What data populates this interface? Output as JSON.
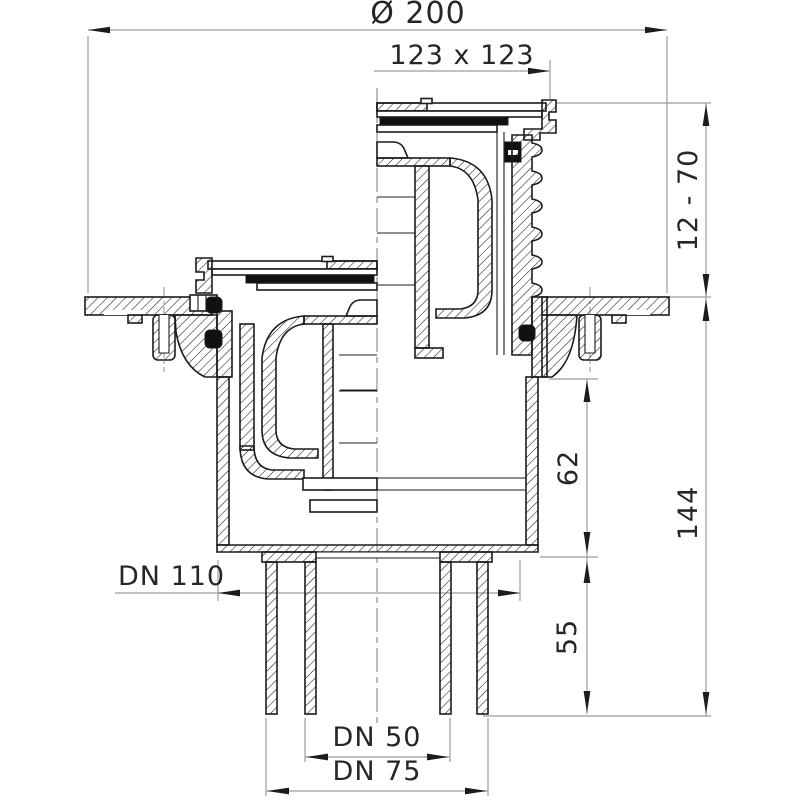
{
  "drawing": {
    "kind": "floor-drain-cross-section",
    "dimensions": {
      "flange_diameter": "Ø 200",
      "grate_size": "123 x 123",
      "height_adjustment": "12 - 70",
      "flange_to_body_bottom": "62",
      "total_height": "144",
      "spigot_length": "55",
      "body_socket": "DN 110",
      "outlet_inner": "DN 50",
      "outlet_outer": "DN 75"
    },
    "colors": {
      "outline": "#1c1c1c",
      "dimension_line": "#9c9c9c",
      "label_text": "#262626",
      "seal_fill": "#111111",
      "background": "#ffffff"
    }
  }
}
